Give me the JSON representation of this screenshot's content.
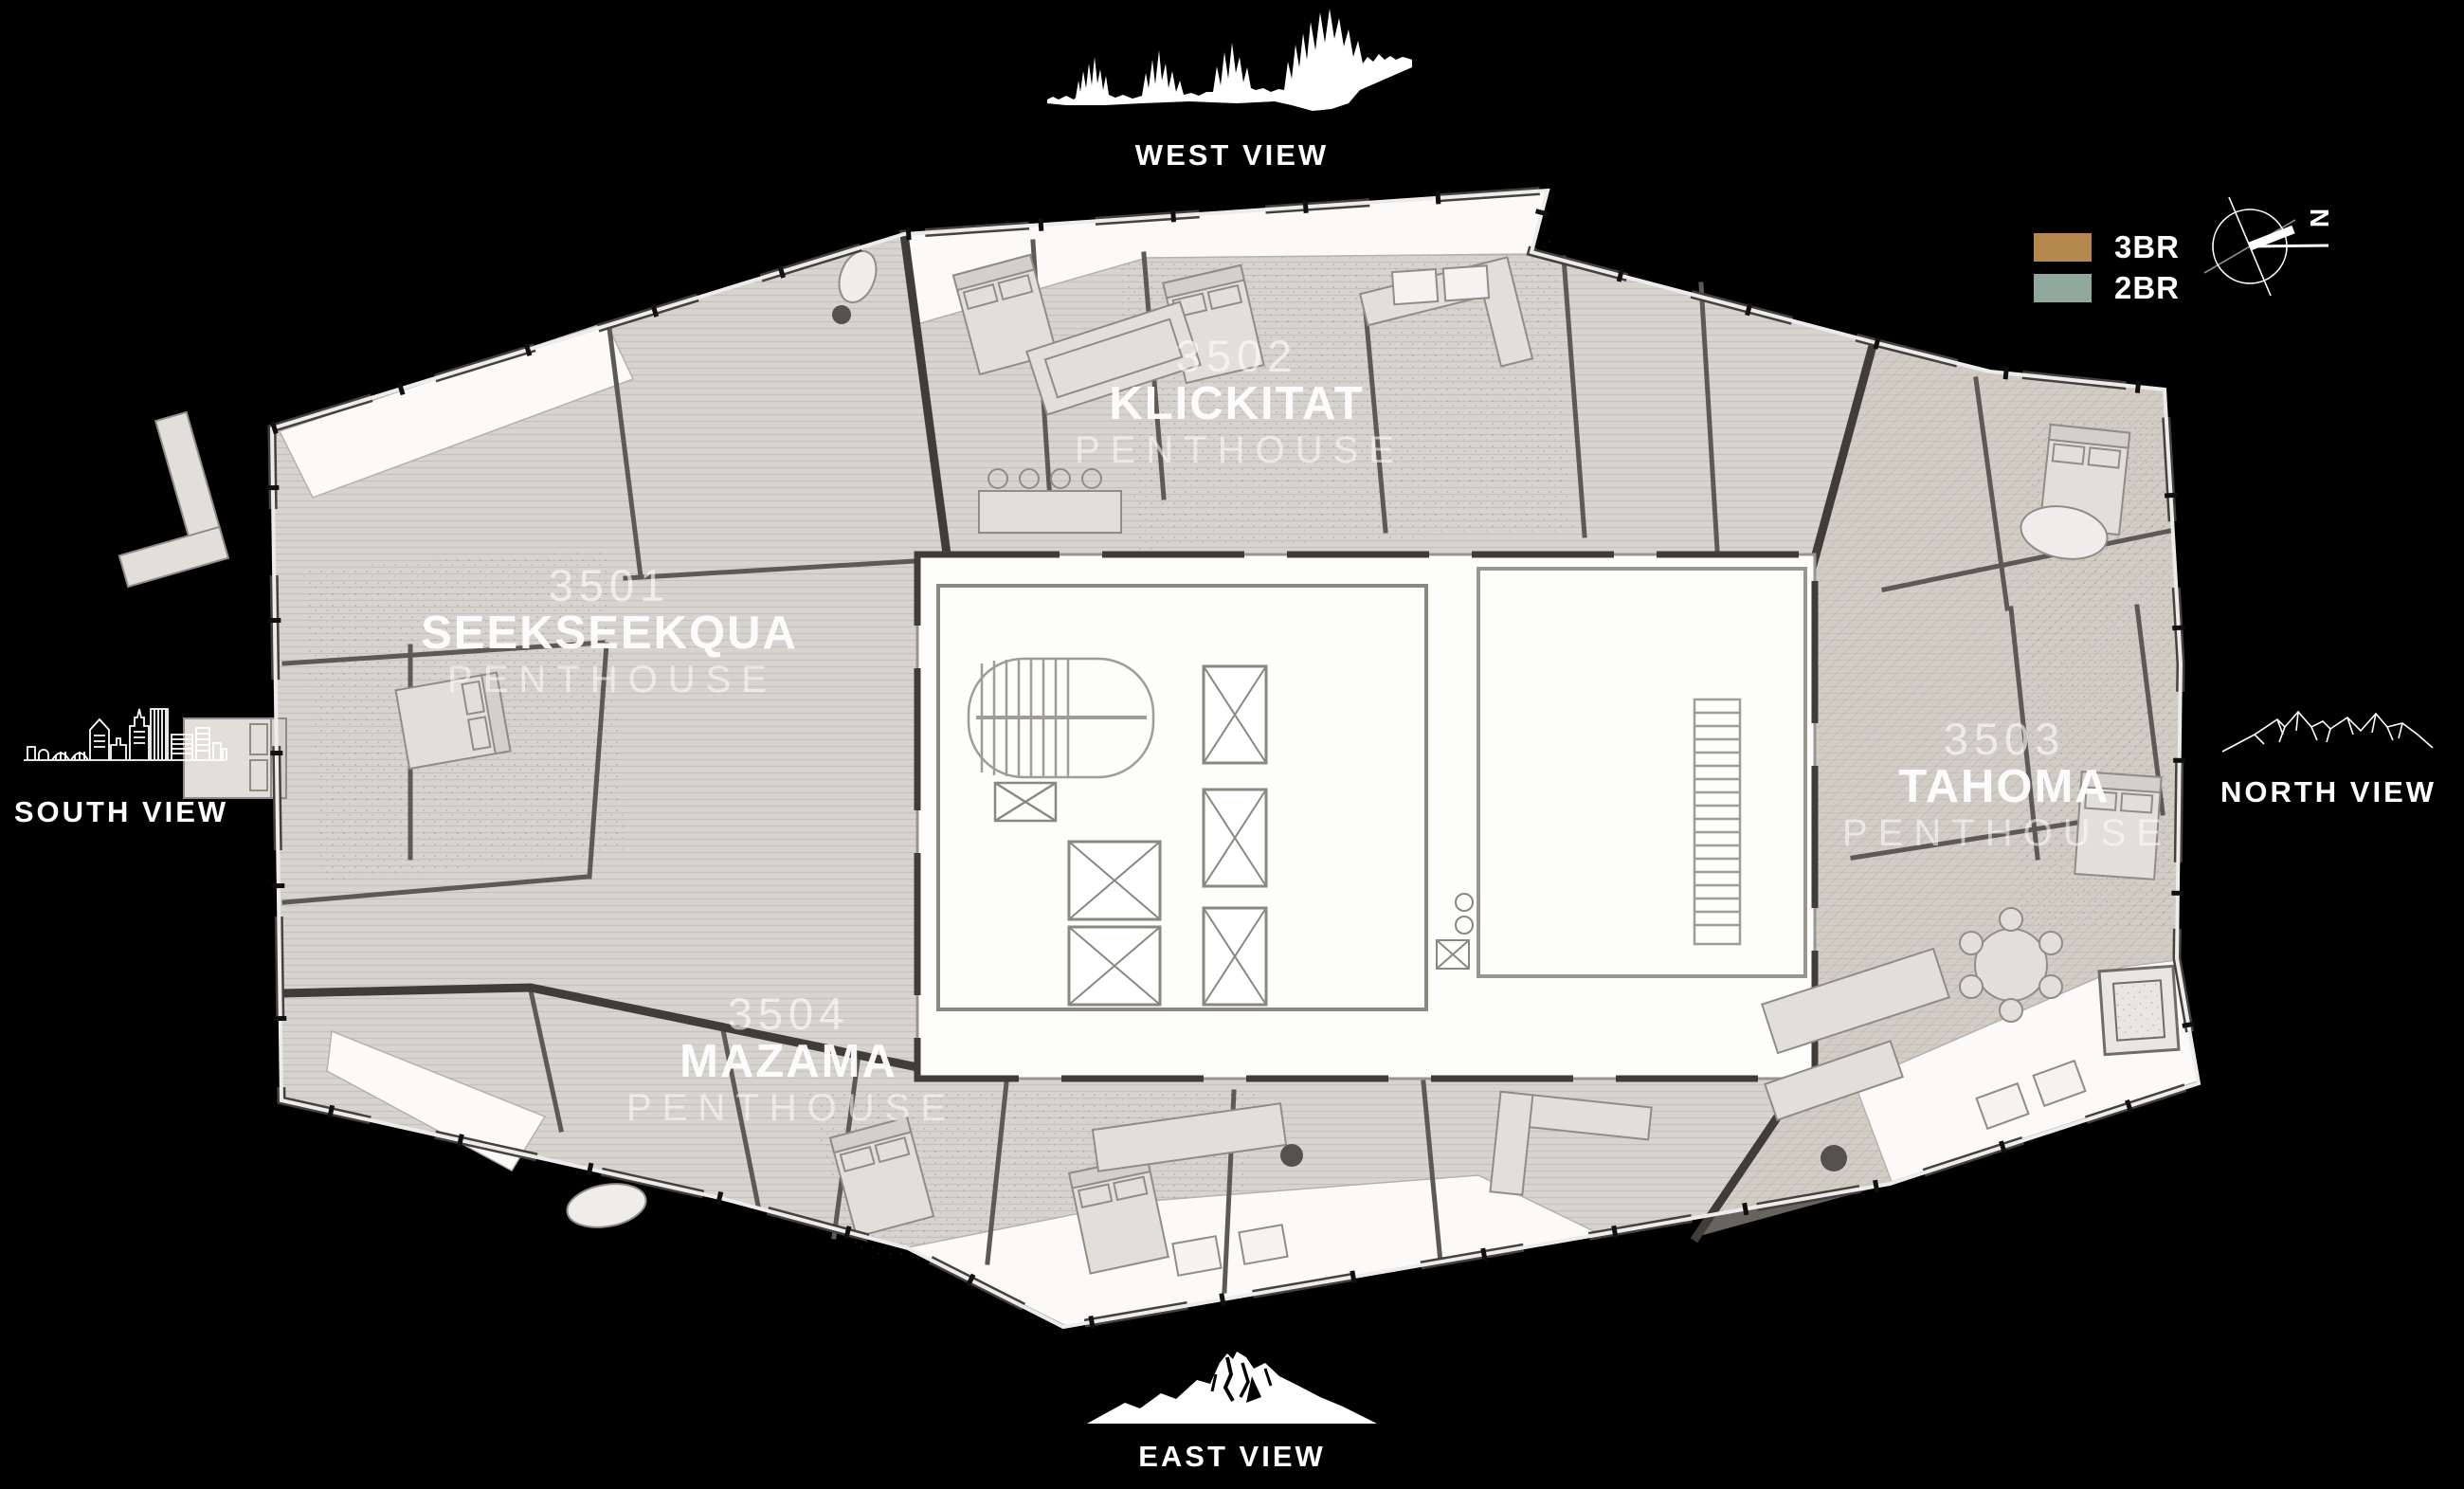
{
  "page": {
    "background": "#000000"
  },
  "views": {
    "west": {
      "label": "WEST VIEW",
      "illustration": "treeline-silhouette"
    },
    "south": {
      "label": "SOUTH VIEW",
      "illustration": "city-skyline-outline"
    },
    "north": {
      "label": "NORTH VIEW",
      "illustration": "mountain-ridge-outline"
    },
    "east": {
      "label": "EAST VIEW",
      "illustration": "mountain-silhouette"
    }
  },
  "legend": {
    "items": [
      {
        "label": "3BR",
        "color": "#b5894e"
      },
      {
        "label": "2BR",
        "color": "#8fa79d"
      }
    ],
    "compass": {
      "label": "N"
    }
  },
  "floor_plan": {
    "level_units": [
      {
        "number": "3501",
        "name": "SEEKSEEKQUA",
        "type": "PENTHOUSE"
      },
      {
        "number": "3502",
        "name": "KLICKITAT",
        "type": "PENTHOUSE"
      },
      {
        "number": "3503",
        "name": "TAHOMA",
        "type": "PENTHOUSE"
      },
      {
        "number": "3504",
        "name": "MAZAMA",
        "type": "PENTHOUSE"
      }
    ],
    "colors": {
      "floor": "#d7d4d0",
      "floor_warm": "#cdc6bb",
      "walls": "#403d39",
      "partitions": "#5d5955",
      "terrace": "#fbfaf9",
      "core": "#fdfdfc",
      "glass": "#edecea"
    }
  }
}
